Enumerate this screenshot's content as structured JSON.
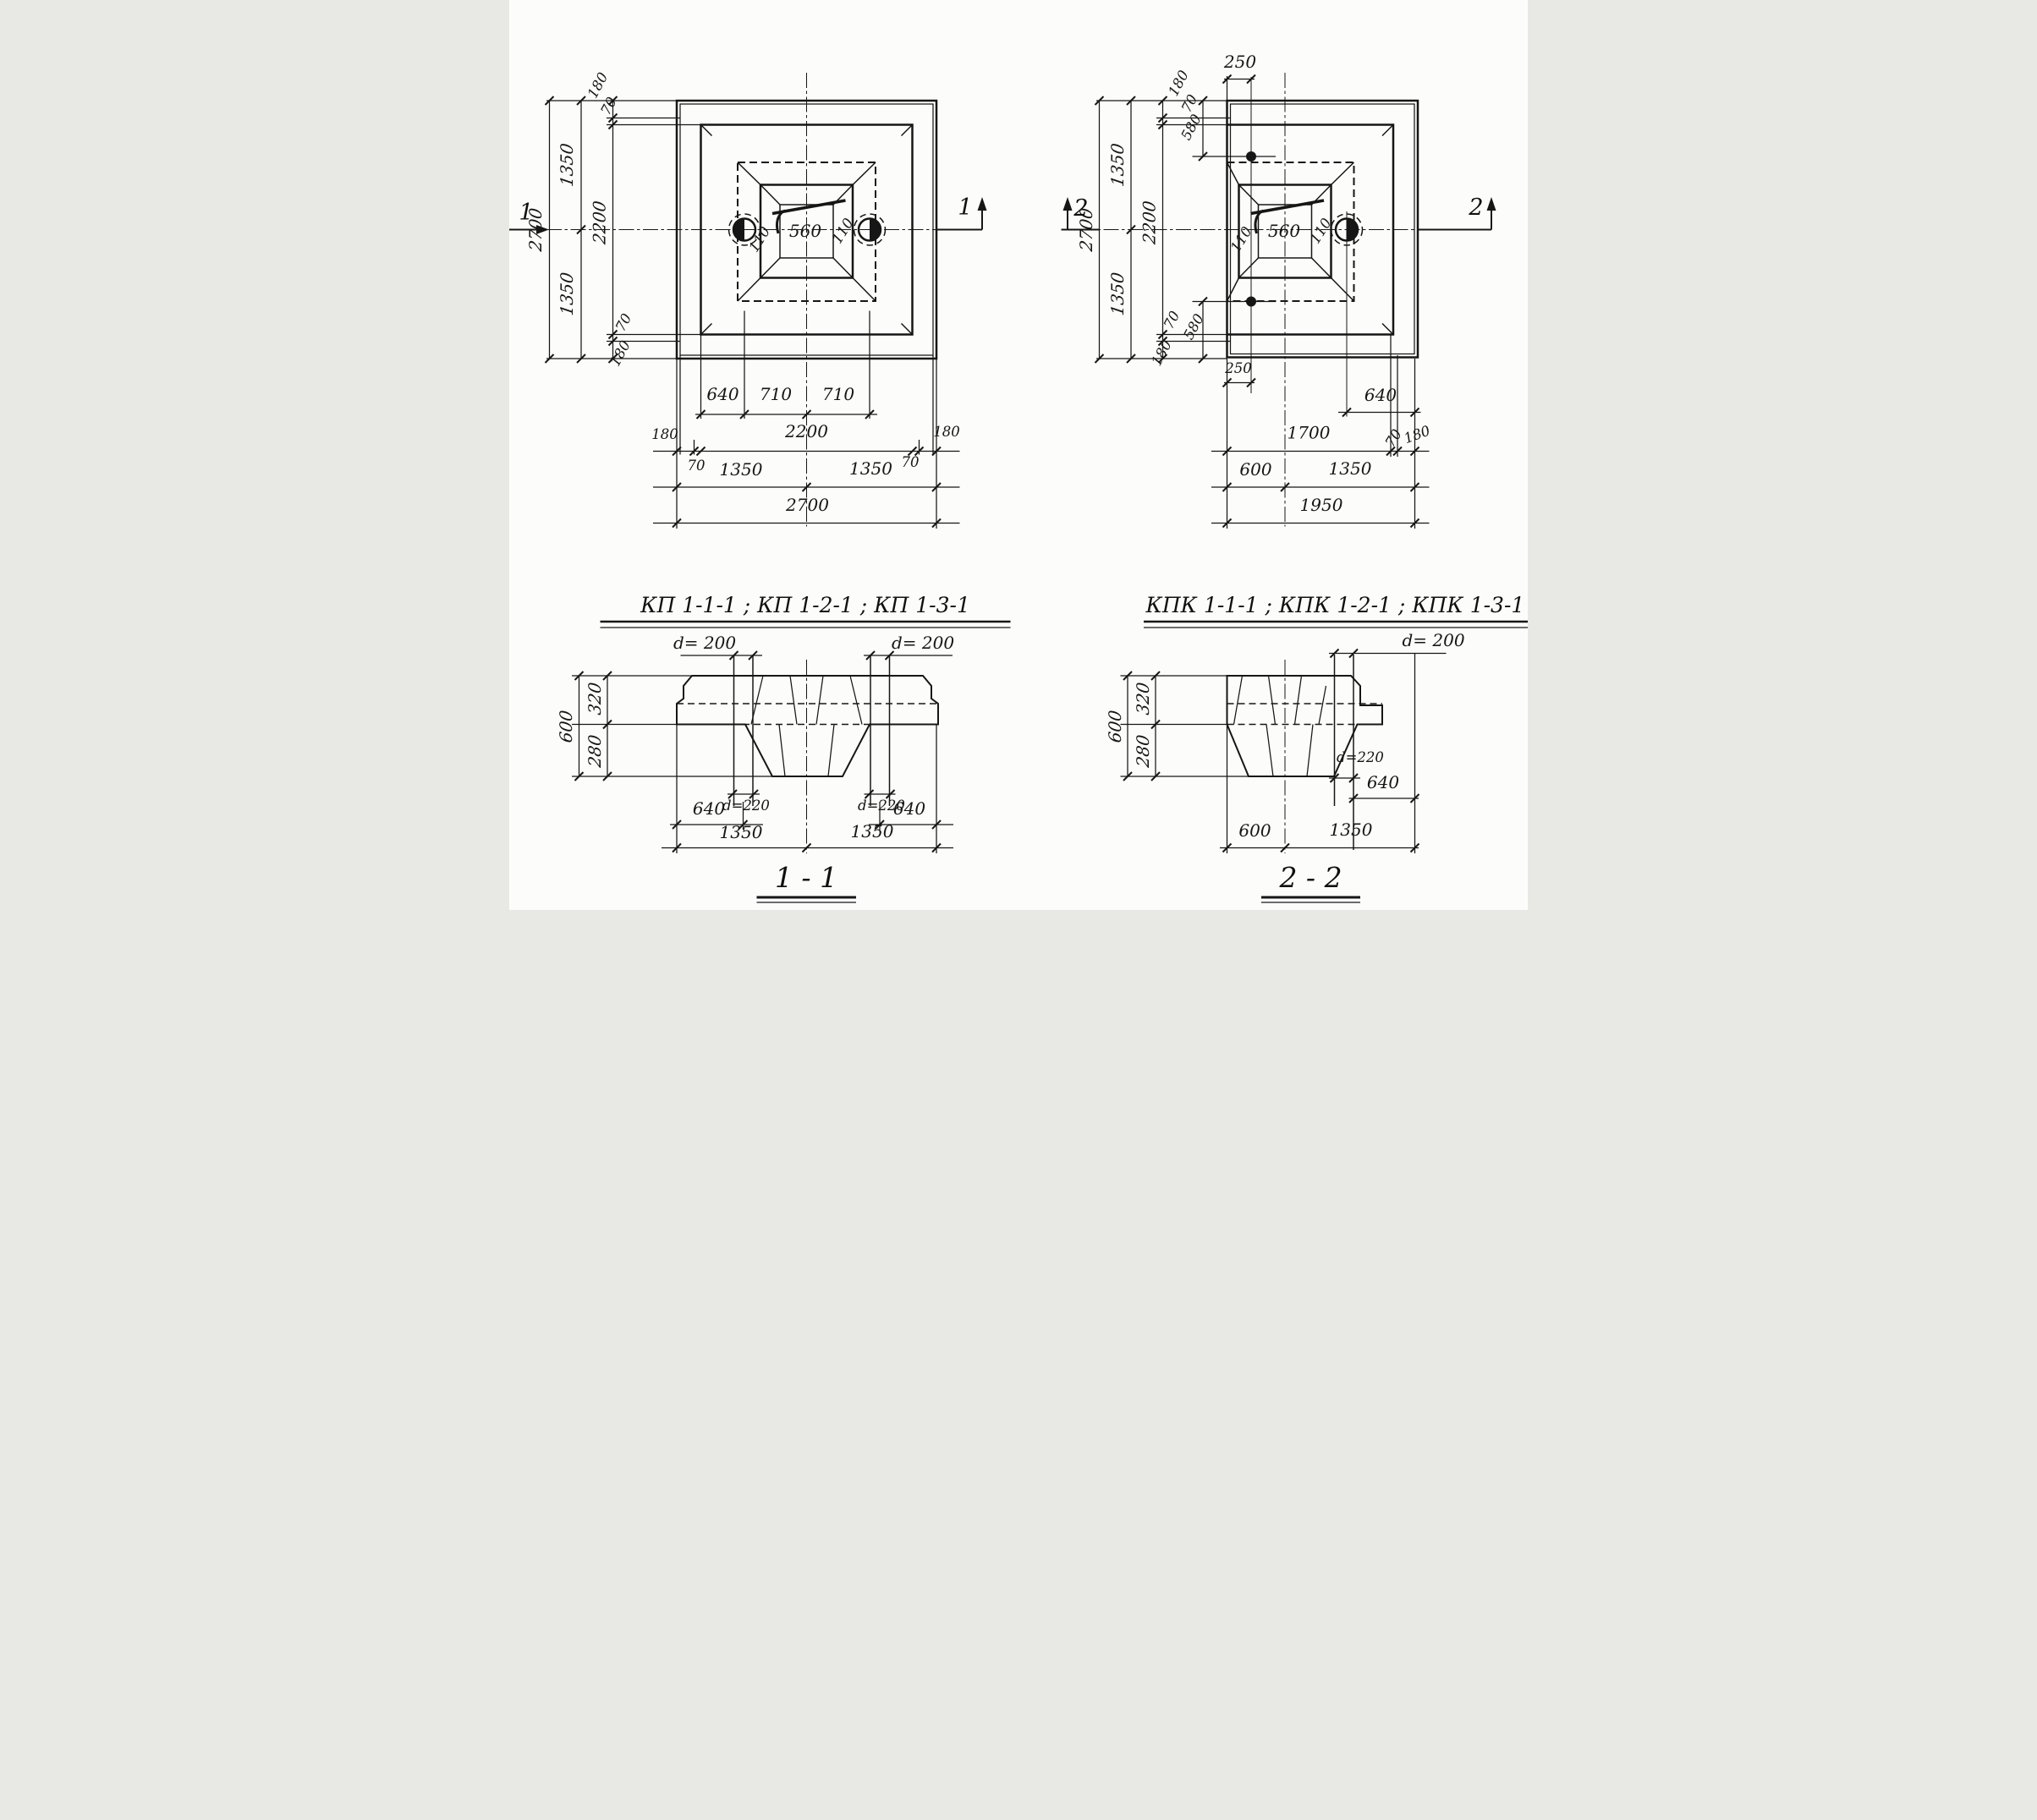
{
  "colors": {
    "ink": "#161616",
    "paper": "#fcfcfa"
  },
  "titles": {
    "plan1": "КП 1-1-1 ; КП 1-2-1 ; КП 1-3-1",
    "plan2": "КПК 1-1-1 ; КПК 1-2-1 ; КПК 1-3-1"
  },
  "plan1": {
    "marker": "1",
    "left": {
      "overall": "2700",
      "half_top": "1350",
      "half_bottom": "1350",
      "inner": "2200",
      "edge_top": "180",
      "lip_top": "70",
      "lip_bottom": "70",
      "edge_bottom": "180"
    },
    "center": {
      "socket": "560",
      "lip_left": "110",
      "lip_right": "110"
    },
    "bottom": {
      "pile_offset": "640",
      "pile_left": "710",
      "pile_right": "710",
      "edge_left": "180",
      "inner": "2200",
      "edge_right": "180",
      "lip_left": "70",
      "lip_right": "70",
      "half_left": "1350",
      "half_right": "1350",
      "overall": "2700"
    }
  },
  "plan2": {
    "marker": "2",
    "left": {
      "overall": "2700",
      "half_top": "1350",
      "half_bottom": "1350",
      "inner": "2200",
      "edge_top": "180",
      "lip_top": "70",
      "anchor_top": "580",
      "lip_bottom": "70",
      "anchor_bottom": "580",
      "edge_bottom": "180"
    },
    "center": {
      "socket": "560",
      "lip_left": "110",
      "lip_right": "110"
    },
    "top": {
      "anchor_offset": "250"
    },
    "bottom": {
      "anchor_offset": "250",
      "pile_offset": "640",
      "inner": "1700",
      "lip_right": "70",
      "edge_right": "180",
      "col_offset": "600",
      "half_right": "1350",
      "overall": "1950"
    }
  },
  "section1": {
    "label": "1 - 1",
    "pile_d_left": "d= 200",
    "pile_d_right": "d= 200",
    "height": "600",
    "upper": "320",
    "lower": "280",
    "sleeve_left": "d=220",
    "sleeve_right": "d=220",
    "pile_off_left": "640",
    "pile_off_right": "640",
    "half_left": "1350",
    "half_right": "1350"
  },
  "section2": {
    "label": "2 - 2",
    "pile_d": "d= 200",
    "height": "600",
    "upper": "320",
    "lower": "280",
    "sleeve": "d=220",
    "pile_off": "640",
    "col_offset": "600",
    "half": "1350"
  }
}
